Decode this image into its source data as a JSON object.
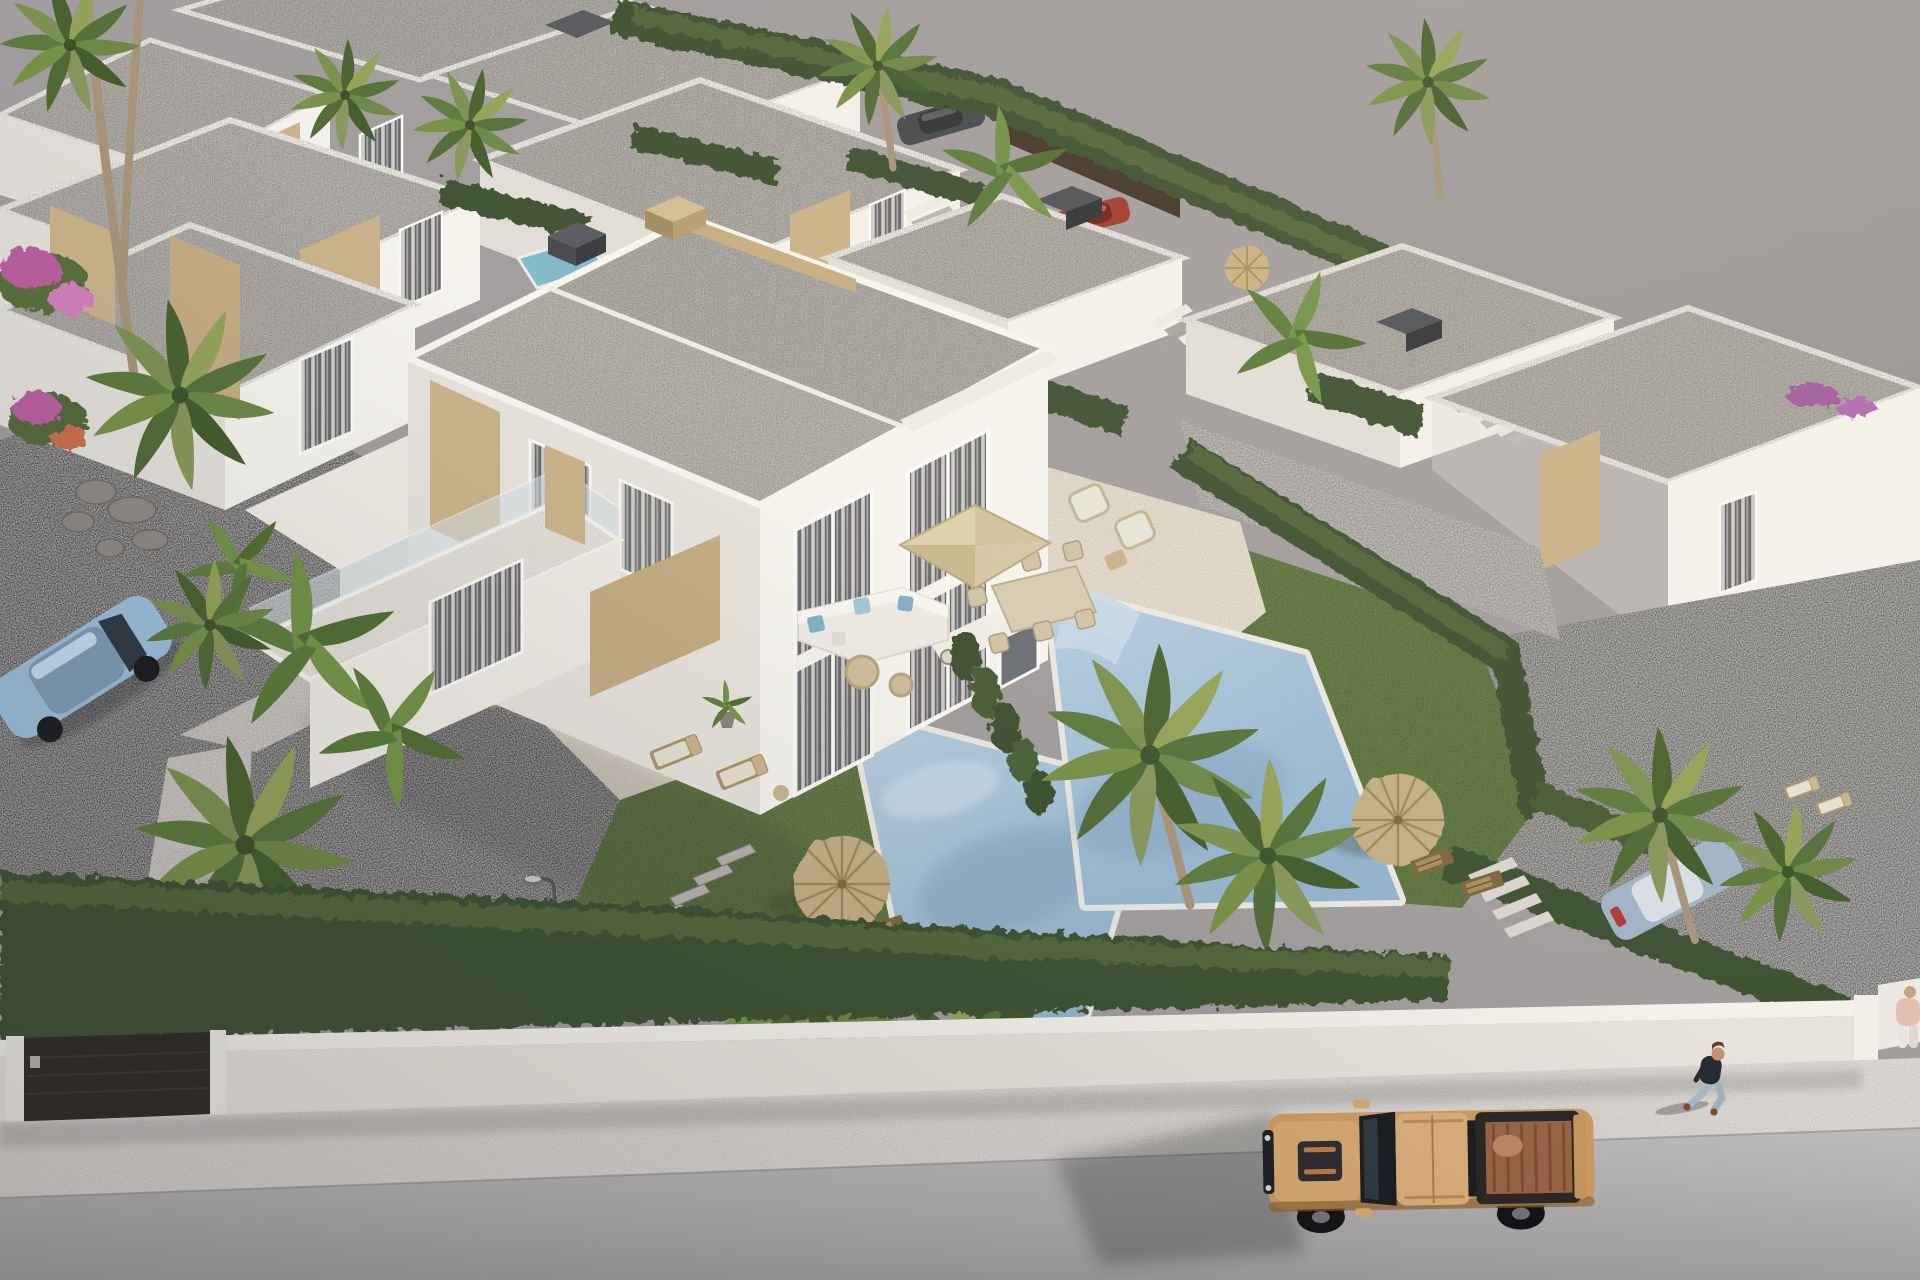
{
  "meta": {
    "title": "Aerial 3D architectural render - modern villa development with private pools",
    "type": "exterior-visualization",
    "view": "aerial-oblique",
    "time_of_day": "late afternoon sun from upper right"
  },
  "palette": {
    "ground": "#a19d9e",
    "empty_lot": "#9a9798",
    "road": "#b2afb0",
    "sidewalk": "#ccc8c3",
    "wall_top": "#f4f1eb",
    "wall_front": "#e7e3dc",
    "wall_lit": "#f6f4ef",
    "wall_shade": "#e0ddd7",
    "roof_gravel": "#b5b2ad",
    "stone": "#c9b289",
    "glass": "#63676e",
    "curtain": "#d8d4cd",
    "hedge_dark": "#3d5130",
    "hedge_light": "#57693e",
    "lawn": "#67804a",
    "pool_water": "#a2c0d8",
    "pool_light": "#c6dbe9",
    "deck": "#d5cbba",
    "gravel_dark": "#4d4a47",
    "gravel_neighbor": "#646260",
    "thatch": "#c2ae85",
    "umbrella_beige": "#d5c8a6",
    "umbrella_terracotta": "#b4674b",
    "gate": "#2e2a25",
    "truck_body": "#cf9d63",
    "truck_dark": "#1b1d21",
    "truck_bed": "#9a6546",
    "car_blue": "#9bbfdb",
    "person_shirt": "#262932",
    "person_jeans": "#a9b6c4"
  },
  "inventory": {
    "villas_visible": 11,
    "private_pools": 2,
    "plunge_pools": 1,
    "palm_trees": 14,
    "banana_plants": 5,
    "hedgerows": 10,
    "umbrellas": {
      "thatch": 2,
      "fabric_square": 1,
      "terracotta": 1,
      "straw": 1
    },
    "vehicles": {
      "pickup_truck": 1,
      "parked_cars": 4
    },
    "people": 2,
    "sun_loungers": 8,
    "deck_chairs": 4,
    "outdoor_sofas": 1,
    "dining_sets": 1,
    "street_lamps": 1,
    "driveway_gates": 1,
    "stepping_stones": 9,
    "roof_terraces_with_stairs": 3
  }
}
